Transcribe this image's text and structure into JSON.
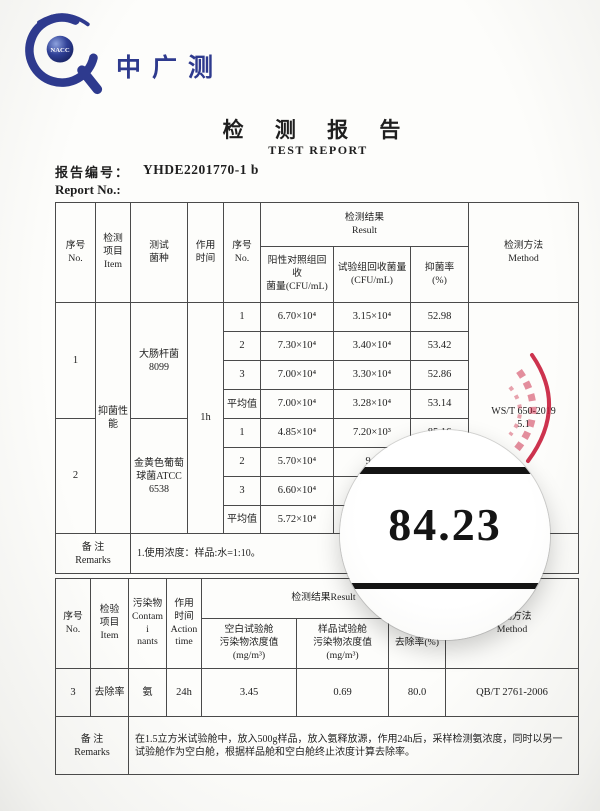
{
  "colors": {
    "brand_navy": "#2e3a8e",
    "stamp_red": "#c81e3c",
    "table_border": "#4a4a4a"
  },
  "logo": {
    "text": "中广测",
    "badge": "NACC"
  },
  "title": {
    "zh": "检 测 报 告",
    "en": "TEST REPORT"
  },
  "report_no": {
    "label_zh": "报告编号：",
    "value": "YHDE2201770-1 b",
    "label_en": "Report No.:"
  },
  "table1": {
    "h_no": "序号\nNo.",
    "h_item": "检测\n项目\nItem",
    "h_strain": "测试\n菌种",
    "h_time": "作用\n时间",
    "h_no2": "序号\nNo.",
    "h_result": "检测结果\nResult",
    "h_positive": "阳性对照组回收\n菌量(CFU/mL)",
    "h_test": "试验组回收菌量\n(CFU/mL)",
    "h_rate": "抑菌率\n(%)",
    "h_method": "检测方法\nMethod",
    "item": "抑菌性\n能",
    "time": "1h",
    "method": "WS/T 650-2019\n5.1",
    "group1": {
      "no": "1",
      "strain": "大肠杆菌\n8099",
      "rows": [
        {
          "no": "1",
          "pos": "6.70×10⁴",
          "test": "3.15×10⁴",
          "rate": "52.98"
        },
        {
          "no": "2",
          "pos": "7.30×10⁴",
          "test": "3.40×10⁴",
          "rate": "53.42"
        },
        {
          "no": "3",
          "pos": "7.00×10⁴",
          "test": "3.30×10⁴",
          "rate": "52.86"
        },
        {
          "no": "平均值",
          "pos": "7.00×10⁴",
          "test": "3.28×10⁴",
          "rate": "53.14"
        }
      ]
    },
    "group2": {
      "no": "2",
      "strain": "金黄色葡萄\n球菌ATCC\n6538",
      "rows": [
        {
          "no": "1",
          "pos": "4.85×10⁴",
          "test": "7.20×10³",
          "rate": "85.16"
        },
        {
          "no": "2",
          "pos": "5.70×10⁴",
          "test": "9.0",
          "rate": ""
        },
        {
          "no": "3",
          "pos": "6.60×10⁴",
          "test": "",
          "rate": ""
        },
        {
          "no": "平均值",
          "pos": "5.72×10⁴",
          "test": "",
          "rate": ""
        }
      ]
    },
    "remarks_label": "备 注\nRemarks",
    "remarks": "1.使用浓度：样品:水=1:10。"
  },
  "table2": {
    "h_no": "序号\nNo.",
    "h_item": "检验\n项目\nItem",
    "h_contaminant": "污染物\nContami\nnants",
    "h_time": "作用\n时间\nAction\ntime",
    "h_result": "检测结果Result",
    "h_blank": "空白试验舱\n污染物浓度值\n(mg/m³)",
    "h_sample": "样品试验舱\n污染物浓度值\n(mg/m³)",
    "h_rate": "去除率(%)",
    "h_method": "检测方法\nMethod",
    "row": {
      "no": "3",
      "item": "去除率",
      "contaminant": "氨",
      "time": "24h",
      "blank": "3.45",
      "sample": "0.69",
      "rate": "80.0",
      "method": "QB/T 2761-2006"
    },
    "remarks_label": "备 注\nRemarks",
    "remarks": "在1.5立方米试验舱中，放入500g样品，放入氨释放源，作用24h后，采样检测氨浓度，同时以另一试验舱作为空白舱，根据样品舱和空白舱终止浓度计算去除率。"
  },
  "magnifier": {
    "value": "84.23"
  }
}
